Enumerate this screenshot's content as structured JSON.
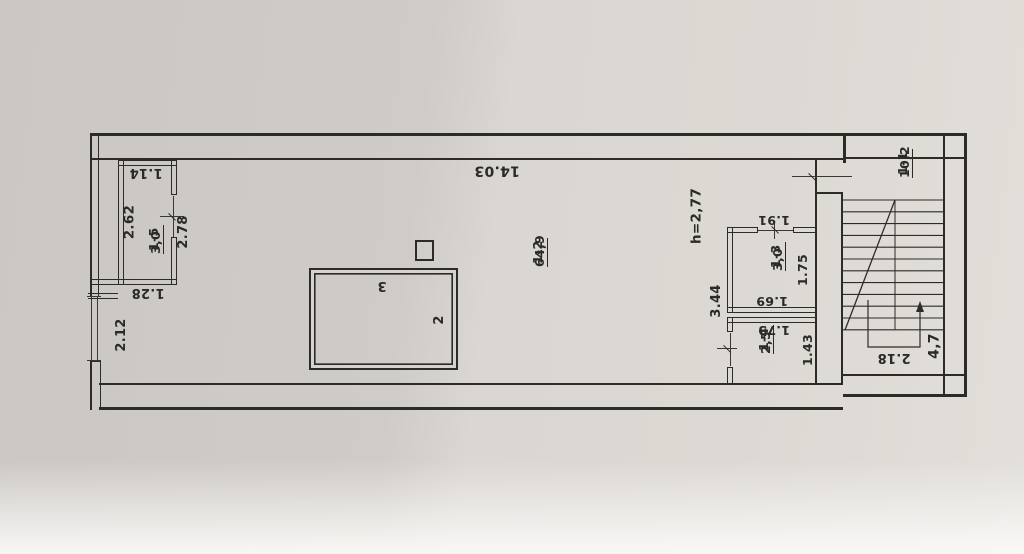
{
  "plan": {
    "rooms": [
      {
        "number": "1-5",
        "area": "3,0"
      },
      {
        "number": "1-2",
        "area": "64,9"
      },
      {
        "number": "1-3",
        "area": "3,0"
      },
      {
        "number": "1-4",
        "area": "2,5"
      },
      {
        "number": "1-1",
        "area": "10,2"
      }
    ],
    "height_label": "h=2,77",
    "dims": {
      "room15_width": "1.14",
      "room15_length": "2.62",
      "room15_door": "2.78",
      "room15_offset": "1.28",
      "window_left": "2.12",
      "hall_length": "14.03",
      "room13_door": "1.91",
      "room13_depth": "1.75",
      "room13_width": "1.69",
      "partition_length": "3.44",
      "room14_width": "1.73",
      "room14_depth": "1.43",
      "stair_width": "2.18",
      "stair_length": "4,7"
    },
    "markers": {
      "veranda_top": "3",
      "veranda_side": "2"
    },
    "colors": {
      "ink": "#2d2b28",
      "paper": "#d7d3ce"
    }
  }
}
